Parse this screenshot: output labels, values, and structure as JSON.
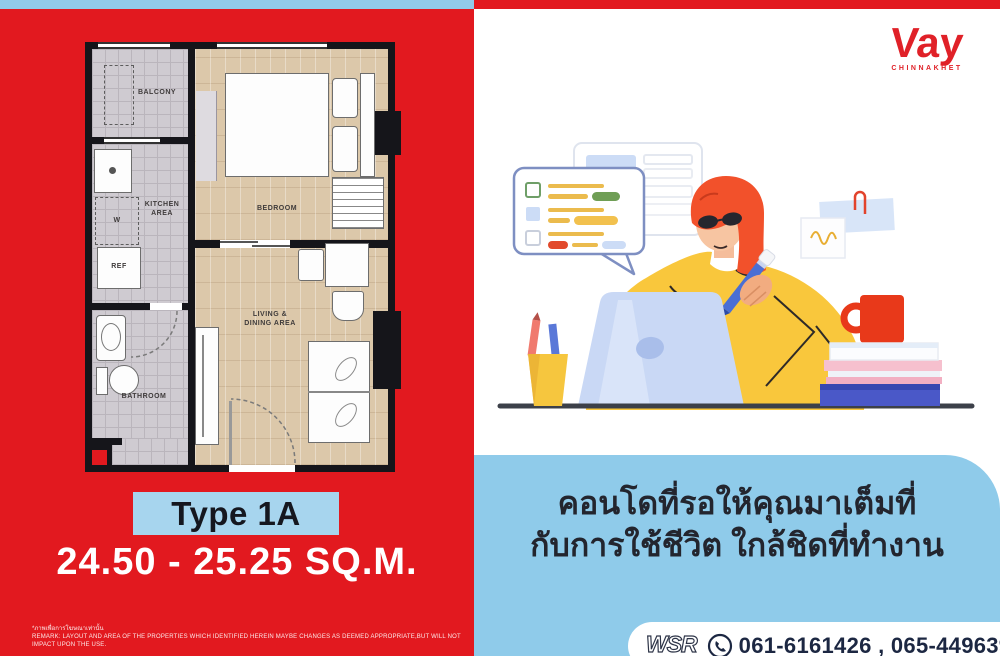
{
  "colors": {
    "red": "#E2191F",
    "light_blue": "#8FCBEA",
    "banner_blue": "#A7D5EE",
    "logo_red": "#E02128",
    "navy": "#1C2742",
    "yellow": "#F9C73C"
  },
  "left_panel": {
    "floor_plan": {
      "labels": {
        "balcony": "BALCONY",
        "kitchen_line1": "KITCHEN",
        "kitchen_line2": "AREA",
        "washer": "W",
        "fridge": "REF",
        "bedroom": "BEDROOM",
        "bathroom": "BATHROOM",
        "living_line1": "LIVING &",
        "living_line2": "DINING AREA"
      }
    },
    "type_label": "Type 1A",
    "area_label": "24.50 - 25.25 SQ.M.",
    "disclaimer_thai": "*ภาพเพื่อการโฆษณาเท่านั้น",
    "disclaimer_en": "REMARK: LAYOUT AND AREA OF THE PROPERTIES WHICH IDENTIFIED HEREIN MAYBE CHANGES AS DEEMED APPROPRIATE,BUT WILL NOT IMPACT UPON THE USE."
  },
  "right_panel": {
    "logo": {
      "name": "Vay",
      "subtitle": "CHINNAKHET"
    },
    "headline_line1": "คอนโดที่รอให้คุณมาเต็มที่",
    "headline_line2": "กับการใช้ชีวิต ใกล้ชิดที่ทำงาน",
    "contact": {
      "brand": "WSR",
      "phones": "061-6161426 , 065-4496399"
    }
  }
}
